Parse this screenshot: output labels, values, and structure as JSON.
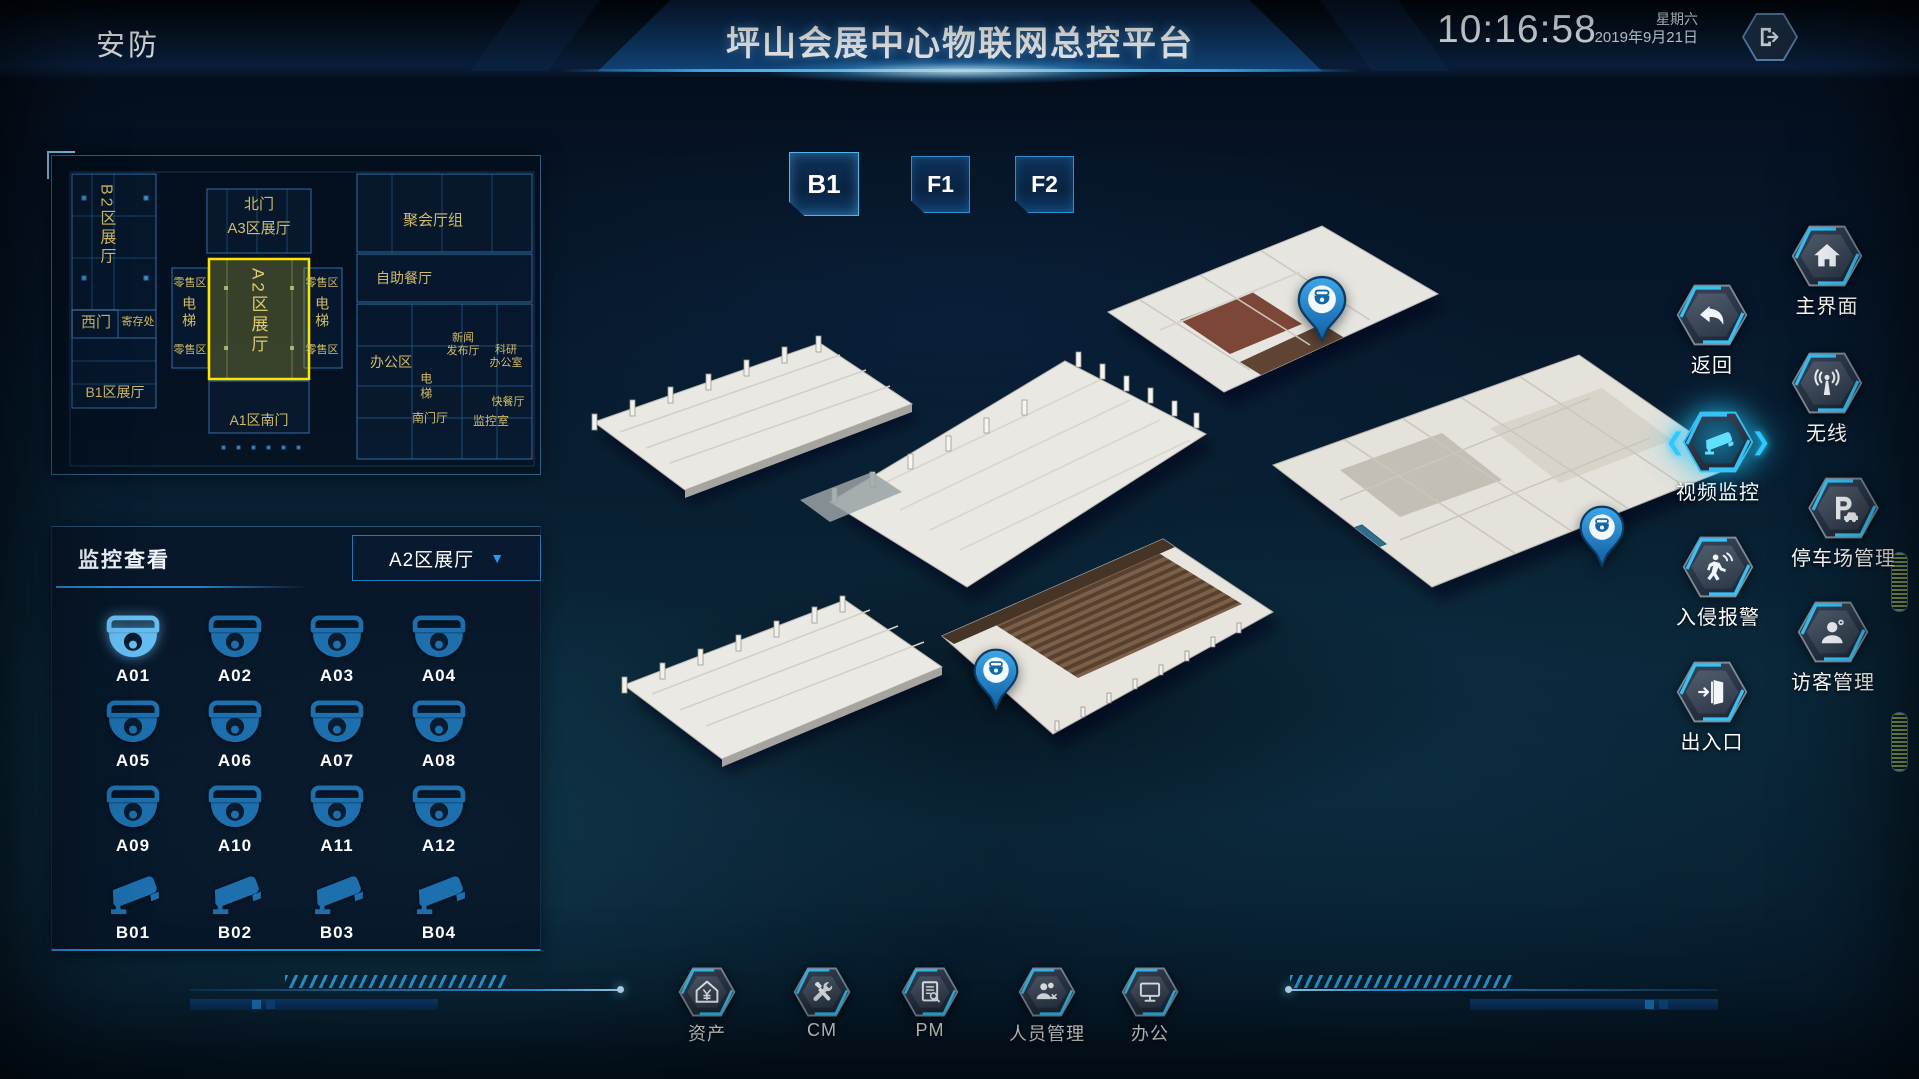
{
  "header": {
    "module": "安防",
    "title": "坪山会展中心物联网总控平台",
    "time": "10:16:58",
    "weekday": "星期六",
    "date": "2019年9月21日"
  },
  "floors": {
    "buttons": [
      {
        "label": "B1",
        "active": true
      },
      {
        "label": "F1",
        "active": false
      },
      {
        "label": "F2",
        "active": false
      }
    ]
  },
  "minimap": {
    "highlight_color": "#ffe600",
    "selected_area": "A2区展厅",
    "labels": [
      {
        "text": "B2区展厅"
      },
      {
        "text": "北门"
      },
      {
        "text": "A3区展厅"
      },
      {
        "text": "聚会厅组"
      },
      {
        "text": "西门"
      },
      {
        "text": "寄存处"
      },
      {
        "text": "B1区展厅"
      },
      {
        "text": "A2区展厅"
      },
      {
        "text": "A1区南门"
      },
      {
        "text": "零售区"
      },
      {
        "text": "零售区"
      },
      {
        "text": "零售区"
      },
      {
        "text": "零售区"
      },
      {
        "text": "电梯"
      },
      {
        "text": "电梯"
      },
      {
        "text": "自助餐厅"
      },
      {
        "text": "办公区"
      },
      {
        "text": "新闻\n发布厅"
      },
      {
        "text": "科研\n办公室"
      },
      {
        "text": "电梯"
      },
      {
        "text": "快餐厅"
      },
      {
        "text": "南门厅"
      },
      {
        "text": "监控室"
      }
    ]
  },
  "monitor_panel": {
    "title": "监控查看",
    "area_selector": {
      "value": "A2区展厅"
    },
    "cameras": [
      {
        "id": "A01",
        "type": "dome",
        "active": true
      },
      {
        "id": "A02",
        "type": "dome",
        "active": false
      },
      {
        "id": "A03",
        "type": "dome",
        "active": false
      },
      {
        "id": "A04",
        "type": "dome",
        "active": false
      },
      {
        "id": "A05",
        "type": "dome",
        "active": false
      },
      {
        "id": "A06",
        "type": "dome",
        "active": false
      },
      {
        "id": "A07",
        "type": "dome",
        "active": false
      },
      {
        "id": "A08",
        "type": "dome",
        "active": false
      },
      {
        "id": "A09",
        "type": "dome",
        "active": false
      },
      {
        "id": "A10",
        "type": "dome",
        "active": false
      },
      {
        "id": "A11",
        "type": "dome",
        "active": false
      },
      {
        "id": "A12",
        "type": "dome",
        "active": false
      },
      {
        "id": "B01",
        "type": "bullet",
        "active": false
      },
      {
        "id": "B02",
        "type": "bullet",
        "active": false
      },
      {
        "id": "B03",
        "type": "bullet",
        "active": false
      },
      {
        "id": "B04",
        "type": "bullet",
        "active": false
      }
    ]
  },
  "right_menu": {
    "items": [
      {
        "label": "主界面",
        "icon": "home-icon",
        "active": false
      },
      {
        "label": "返回",
        "icon": "back-icon",
        "active": false
      },
      {
        "label": "无线",
        "icon": "wireless-icon",
        "active": false
      },
      {
        "label": "视频监控",
        "icon": "cctv-icon",
        "active": true
      },
      {
        "label": "停车场管理",
        "icon": "parking-icon",
        "active": false
      },
      {
        "label": "入侵报警",
        "icon": "intrusion-icon",
        "active": false
      },
      {
        "label": "访客管理",
        "icon": "visitor-icon",
        "active": false
      },
      {
        "label": "出入口",
        "icon": "door-icon",
        "active": false
      }
    ]
  },
  "bottom_menu": {
    "items": [
      {
        "label": "资产",
        "icon": "asset-icon"
      },
      {
        "label": "CM",
        "icon": "tools-icon"
      },
      {
        "label": "PM",
        "icon": "report-icon"
      },
      {
        "label": "人员管理",
        "icon": "people-icon"
      },
      {
        "label": "办公",
        "icon": "office-icon"
      }
    ]
  },
  "colors": {
    "accent": "#35c2f5",
    "camera_blue": "#1d6fad",
    "camera_active": "#66bdf2",
    "highlight_yellow": "#ffe600",
    "blueprint_gold": "#d2bc66"
  }
}
